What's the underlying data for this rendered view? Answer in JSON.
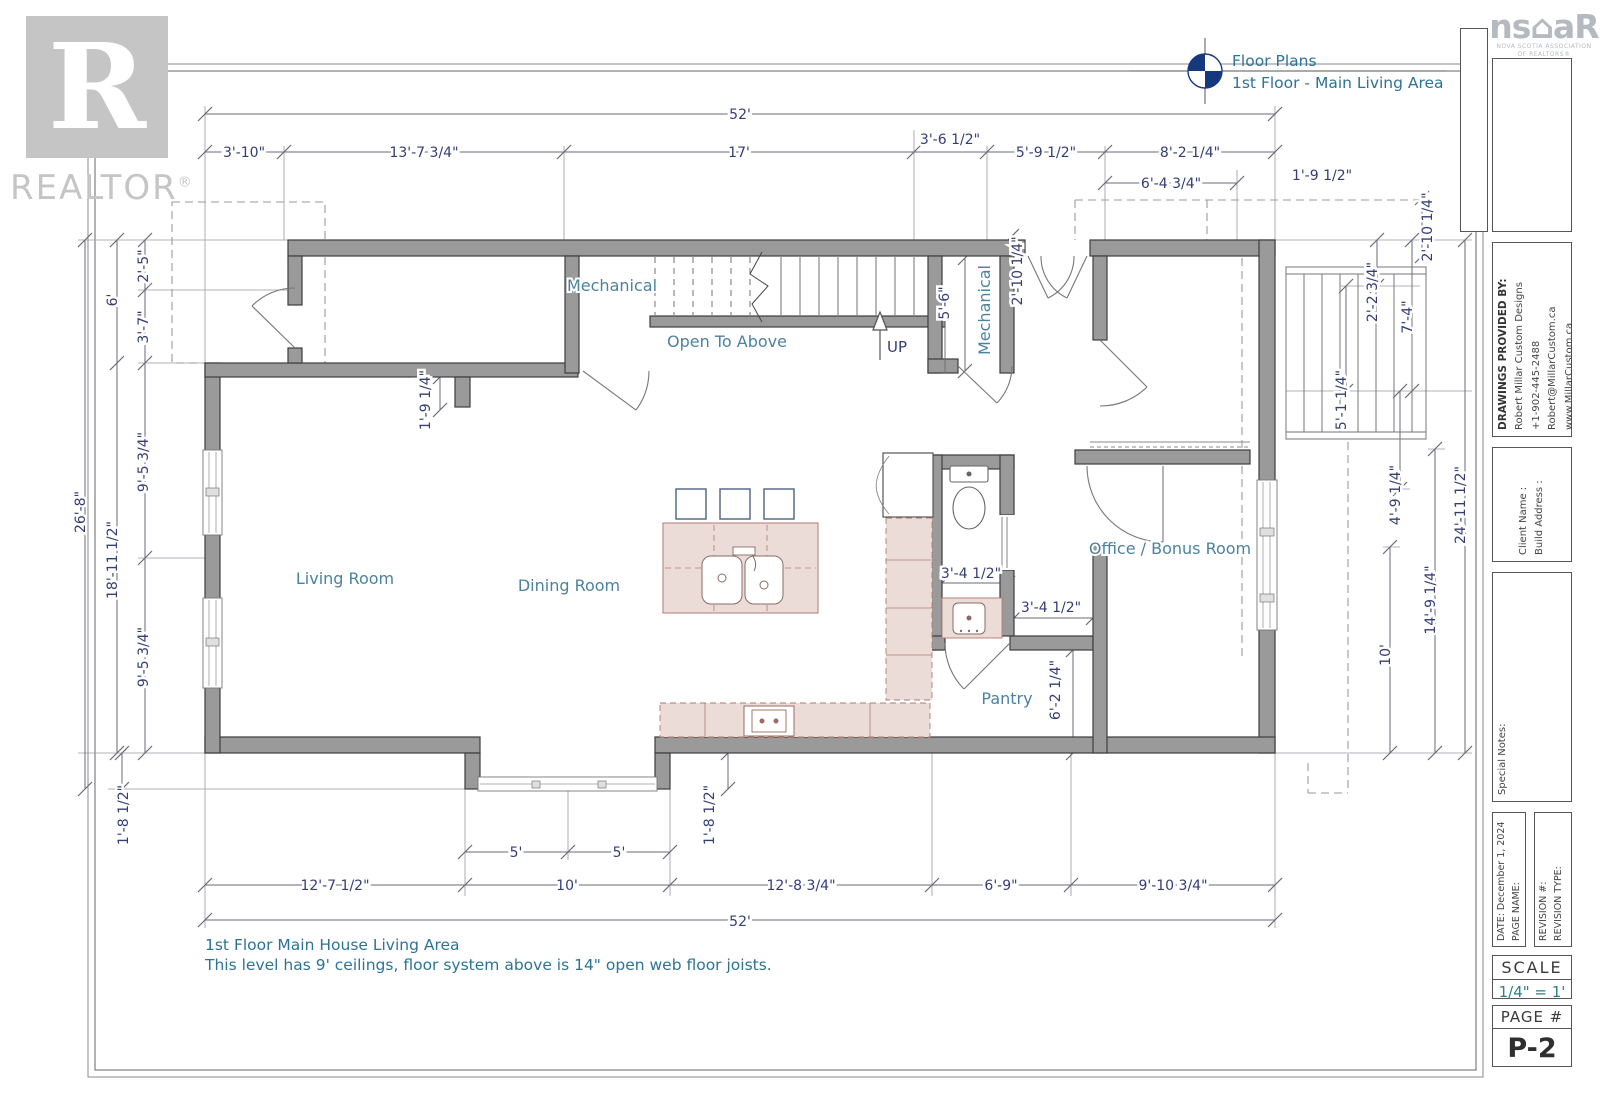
{
  "header": {
    "title": "Floor Plans",
    "subtitle": "1st Floor - Main Living Area"
  },
  "branding": {
    "realtor_letter": "R",
    "realtor_caption": "REALTOR",
    "realtor_reg": "®",
    "nsar_left": "ns",
    "nsar_house": "⌂",
    "nsar_right": "aR",
    "nsar_tagline1": "NOVA SCOTIA ASSOCIATION",
    "nsar_tagline2": "OF REALTORS®"
  },
  "sidebar": {
    "provided_by_label": "DRAWINGS PROVIDED BY:",
    "provided_by": [
      "Robert Millar Custom Designs",
      "+1-902-445-2488",
      "Robert@MillarCustom.ca",
      "www.MillarCustom.ca"
    ],
    "client_name": "Client Name :",
    "build_address": "Build Address :",
    "special_notes": "Special Notes:",
    "date": "DATE: December 1, 2024",
    "page_name": "PAGE NAME:",
    "revision_no": "REVISION #:",
    "revision_type": "REVISION TYPE:",
    "scale_label": "SCALE",
    "scale_value": "1/4\" = 1'",
    "page_label": "PAGE #",
    "page_value": "P-2"
  },
  "plan": {
    "rooms": {
      "mech1": "Mechanical",
      "mech2": "Mechanical",
      "open": "Open To Above",
      "up": "UP",
      "living": "Living Room",
      "dining": "Dining Room",
      "office": "Office / Bonus Room",
      "pantry": "Pantry"
    },
    "dims": {
      "top": [
        "52'",
        "3'-10\"",
        "13'-7 3/4\"",
        "17'",
        "3'-6 1/2\"",
        "5'-9 1/2\"",
        "8'-2 1/4\"",
        "6'-4 3/4\"",
        "1'-9 1/2\"",
        "2'-10 1/4\"",
        "2'-10 1/4\""
      ],
      "left": [
        "26'-8\"",
        "6'",
        "18'-11 1/2\"",
        "2'-5\"",
        "3'-7\"",
        "9'-5 3/4\"",
        "9'-5 3/4\"",
        "1'-8 1/2\""
      ],
      "right": [
        "2'-2 3/4\"",
        "7'-4\"",
        "5'-1 1/4\"",
        "4'-9 1/4\"",
        "24'-11 1/2\"",
        "14'-9 1/4\"",
        "10'"
      ],
      "bottom": [
        "5'",
        "5'",
        "12'-7 1/2\"",
        "10'",
        "12'-8 3/4\"",
        "6'-9\"",
        "9'-10 3/4\"",
        "52'",
        "1'-8 1/2\""
      ],
      "interior": [
        "1'-9 1/4\"",
        "5'-6\"",
        "3'-4 1/2\"",
        "3'-4 1/2\"",
        "6'-2 1/4\""
      ]
    }
  },
  "notes": {
    "line1": "1st Floor Main House Living Area",
    "line2": "This level has 9' ceilings, floor system above is 14\" open web floor joists."
  }
}
